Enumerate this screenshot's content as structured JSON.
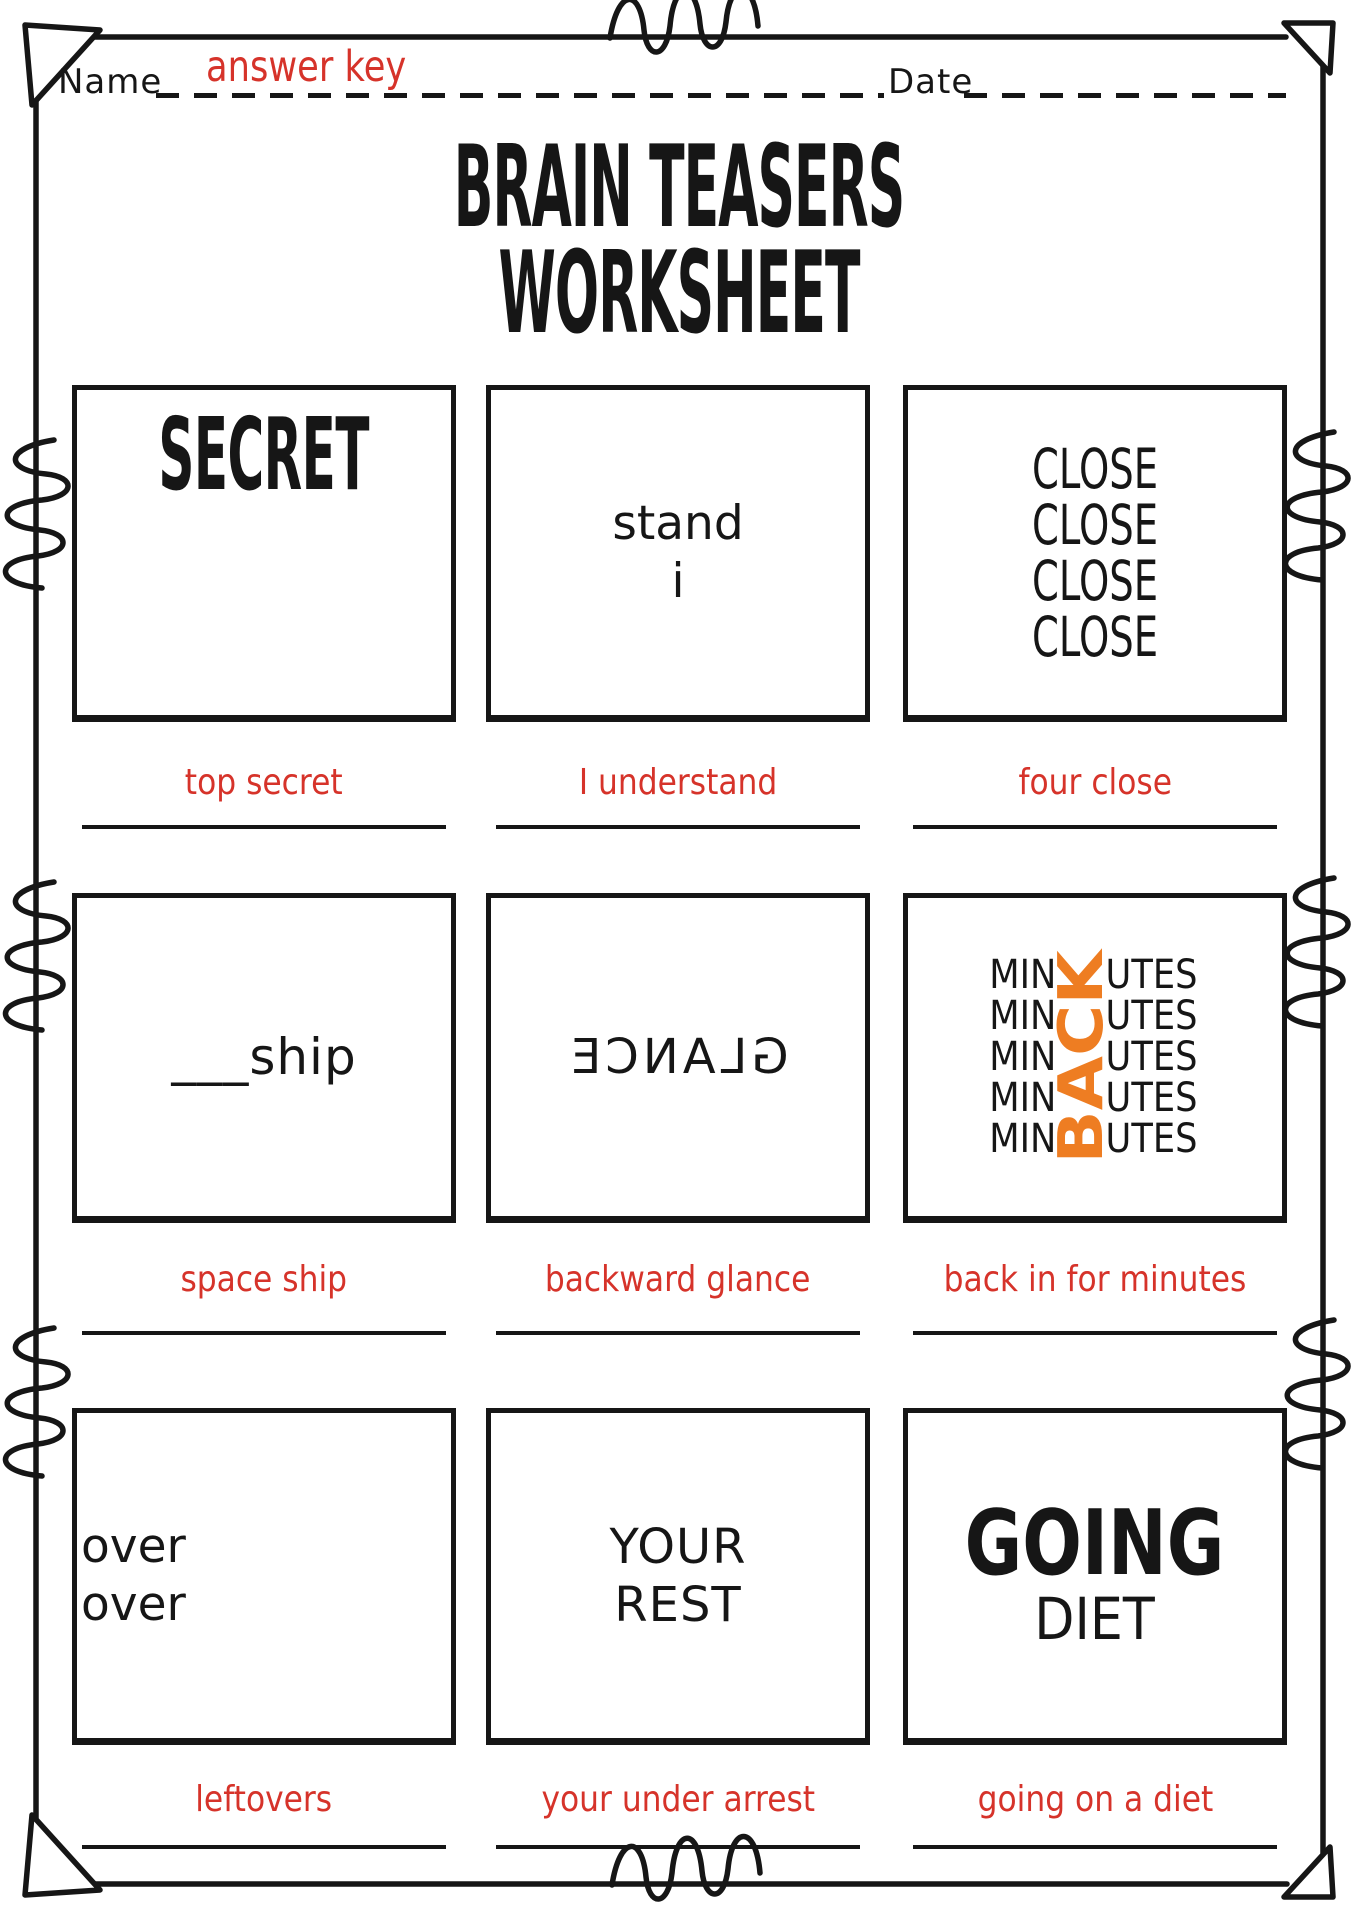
{
  "header": {
    "name_label": "Name",
    "name_value": "answer key",
    "date_label": "Date",
    "date_value": ""
  },
  "title": {
    "line1": "BRAIN TEASERS",
    "line2": "WORKSHEET"
  },
  "colors": {
    "ink": "#161616",
    "answer_red": "#d6332a",
    "back_orange": "#ee7d22"
  },
  "puzzles": {
    "secret": {
      "display": "SECRET",
      "answer": "top secret"
    },
    "stand": {
      "line1": "stand",
      "line2": "i",
      "answer": "I understand"
    },
    "close": {
      "word": "CLOSE",
      "repeat": 4,
      "answer": "four close"
    },
    "ship": {
      "display": "___ship",
      "answer": "space ship"
    },
    "glance": {
      "display": "GLANCE",
      "mirrored": true,
      "answer": "backward glance"
    },
    "minutes": {
      "prefix": "MIN",
      "suffix": "UTES",
      "rows": 5,
      "vertical_word": "BACK",
      "answer": "back in for minutes"
    },
    "over": {
      "line1": "over",
      "line2": "over",
      "answer": "leftovers"
    },
    "rest": {
      "line1": "YOUR",
      "line2": "REST",
      "answer": "your under arrest"
    },
    "diet": {
      "line1": "GOING",
      "line2": "DIET",
      "answer": "going on a diet"
    }
  }
}
